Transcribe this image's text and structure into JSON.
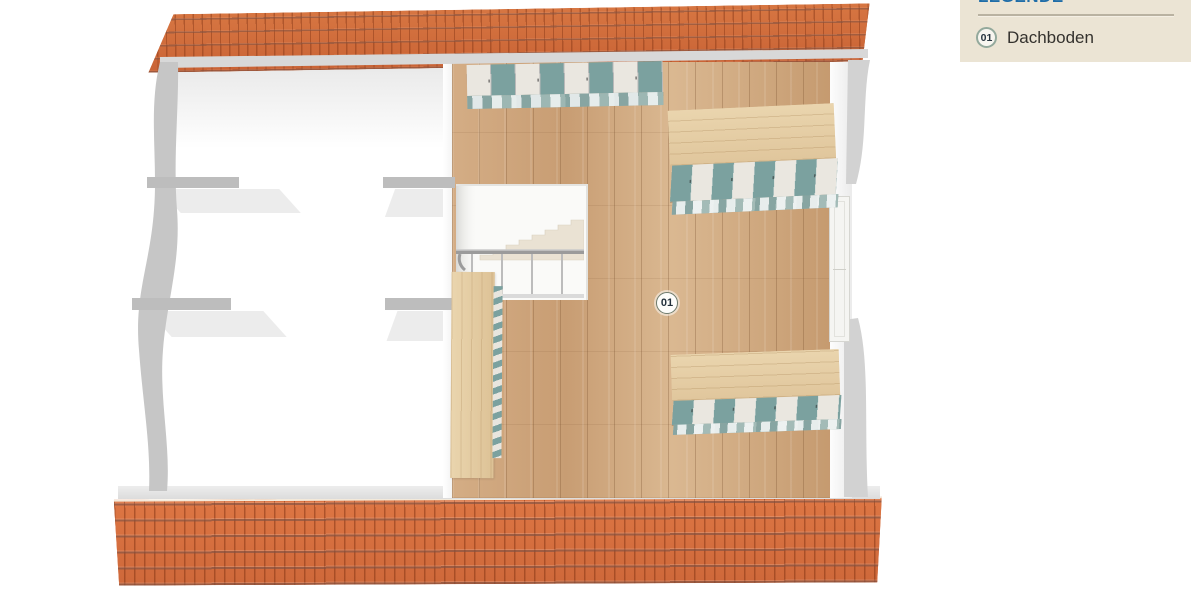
{
  "legend": {
    "title": "LEGENDE",
    "items": [
      {
        "id": "01",
        "label": "Dachboden"
      }
    ]
  },
  "plan": {
    "marker": {
      "id": "01",
      "room": "Dachboden"
    },
    "colors": {
      "roof_tile": "#cd6a39",
      "roof_joint": "#7e3315",
      "wood_floor": "#cfa87f",
      "furniture_top_beech": "#e6cfa7",
      "door_teal": "#7ba19f",
      "door_white": "#eae7e0",
      "wall_gray": "#c6c6c6",
      "attic_floor_white": "#ffffff",
      "legend_bg": "#ebe4d4",
      "legend_title_blue": "#1f6da8"
    }
  }
}
